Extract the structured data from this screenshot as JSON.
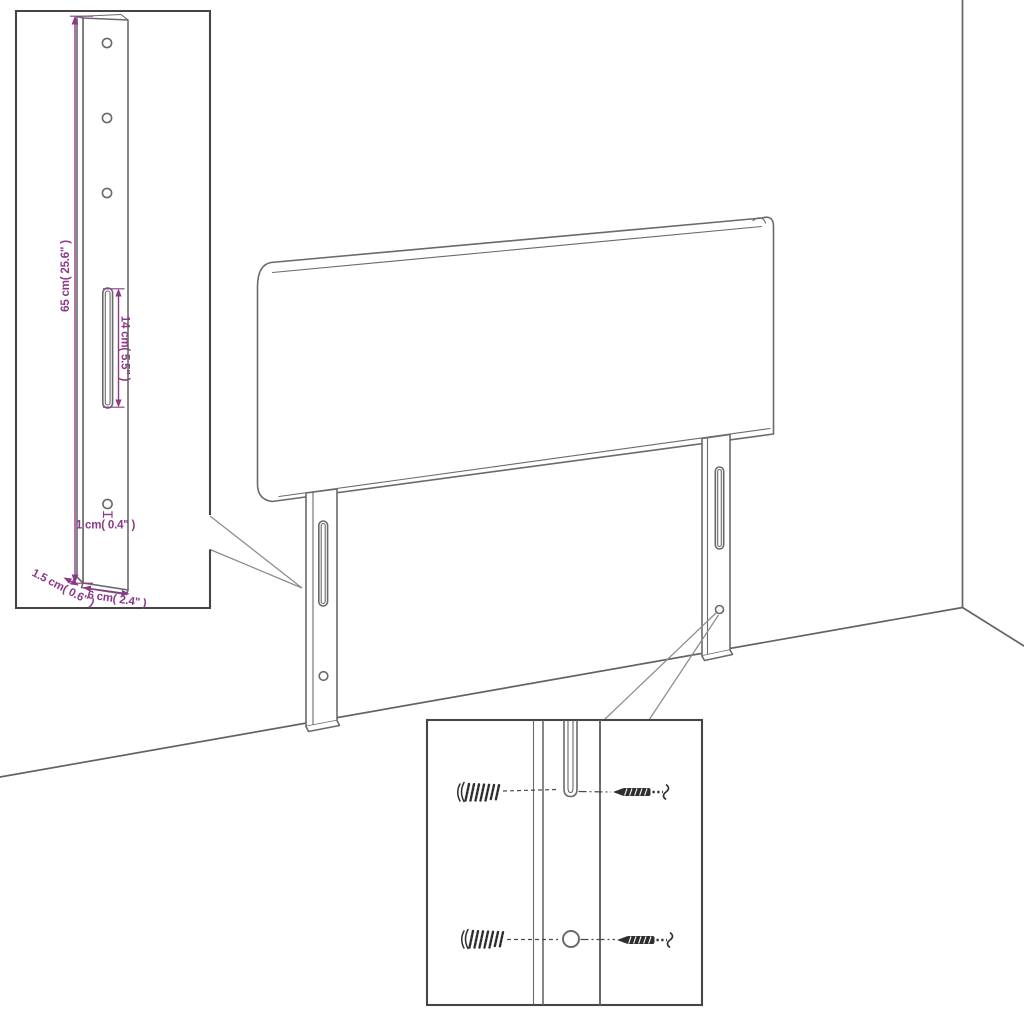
{
  "colors": {
    "background": "#ffffff",
    "outline_gray": "#6a6a6a",
    "inset_border": "#454545",
    "dimension_magenta": "#8b3a87",
    "hardware_dark": "#2e2e2e",
    "leader_gray": "#8c8c8c"
  },
  "bracket_inset": {
    "hole_count": 3,
    "labels": {
      "height": "65 cm( 25.6\" )",
      "slot_length": "14 cm( 5.5\" )",
      "hole_diameter": "1 cm( 0.4\" )",
      "thickness": "1.5 cm( 0.6\" )",
      "width": "6 cm( 2.4\" )"
    }
  },
  "hardware_inset": {
    "wall_plug_count": 2,
    "screw_count": 2
  }
}
